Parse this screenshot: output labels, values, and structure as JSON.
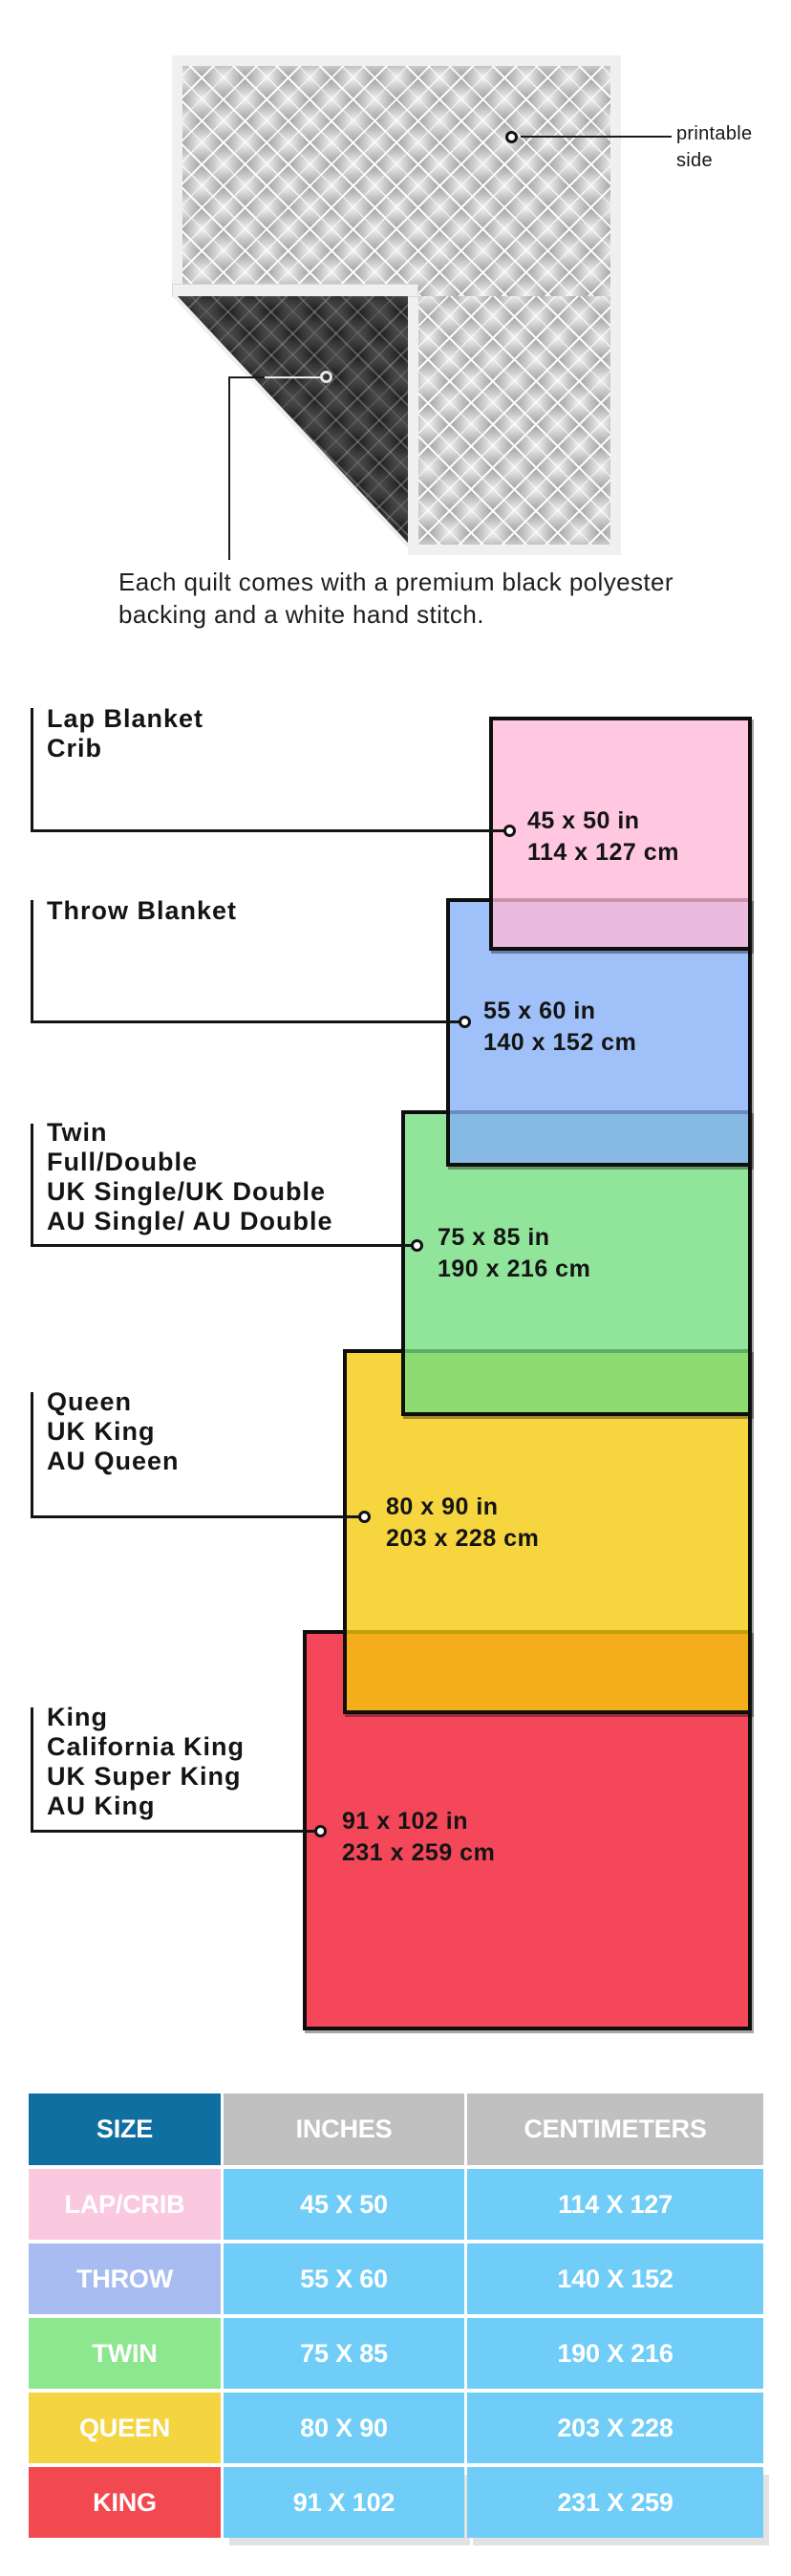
{
  "hero": {
    "printable_label_line1": "printable",
    "printable_label_line2": "side",
    "caption_line1": "Each quilt comes with a premium black polyester",
    "caption_line2": "backing and a white hand stitch.",
    "front_color": "#f2f2f2",
    "backing_color": "#181818"
  },
  "diagram": {
    "groups": [
      {
        "name": "lap-crib",
        "labels": [
          "Lap Blanket",
          "Crib"
        ],
        "inches": "45 x 50 in",
        "centimeters": "114 x 127 cm",
        "fill": "#FBC9E2"
      },
      {
        "name": "throw",
        "labels": [
          "Throw Blanket"
        ],
        "inches": "55 x 60 in",
        "centimeters": "140 x 152 cm",
        "fill": "#9FC0F8"
      },
      {
        "name": "twin",
        "labels": [
          "Twin",
          "Full/Double",
          "UK Single/UK Double",
          "AU Single/ AU Double"
        ],
        "inches": "75 x 85 in",
        "centimeters": "190 x 216 cm",
        "fill": "#90E59B"
      },
      {
        "name": "queen",
        "labels": [
          "Queen",
          "UK King",
          "AU Queen"
        ],
        "inches": "80 x 90 in",
        "centimeters": "203 x 228 cm",
        "fill": "#F6D53F"
      },
      {
        "name": "king",
        "labels": [
          "King",
          "California King",
          "UK Super King",
          "AU King"
        ],
        "inches": "91 x 102 in",
        "centimeters": "231 x 259 cm",
        "fill": "#F4485A"
      }
    ],
    "border_color": "#0e0e0e"
  },
  "table": {
    "headers": [
      "SIZE",
      "INCHES",
      "CENTIMETERS"
    ],
    "rows": [
      {
        "size": "LAP/CRIB",
        "inches": "45 X 50",
        "centimeters": "114 X 127",
        "size_color": "#FAC8DF"
      },
      {
        "size": "THROW",
        "inches": "55 X 60",
        "centimeters": "140 X 152",
        "size_color": "#A9BCF2"
      },
      {
        "size": "TWIN",
        "inches": "75 X 85",
        "centimeters": "190 X 216",
        "size_color": "#8CE78F"
      },
      {
        "size": "QUEEN",
        "inches": "80 X 90",
        "centimeters": "203 X 228",
        "size_color": "#F5D441"
      },
      {
        "size": "KING",
        "inches": "91 X 102",
        "centimeters": "231 X 259",
        "size_color": "#F2484F"
      }
    ],
    "header_size_color": "#0F6FA0",
    "header_gray_color": "#C0C0C0",
    "data_cell_color": "#6FCDF7",
    "text_color": "#ffffff"
  }
}
